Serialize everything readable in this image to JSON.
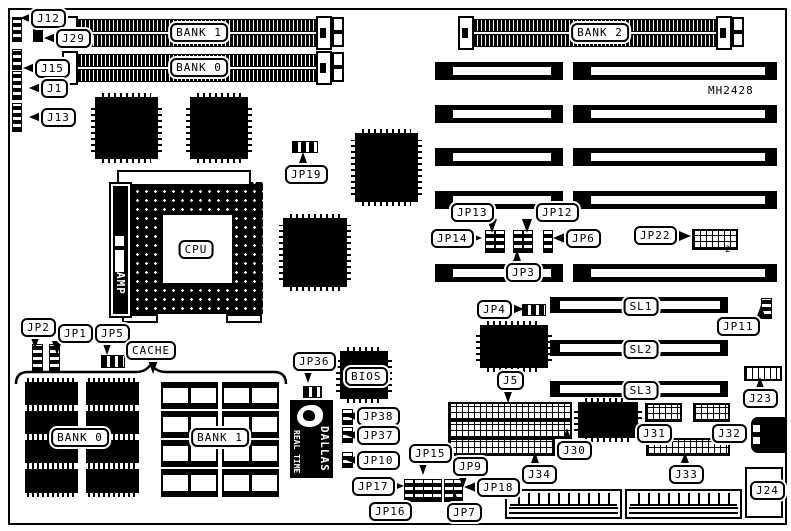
{
  "board": {
    "part_number": "MH2428"
  },
  "memory": {
    "simm_bank1": "BANK 1",
    "simm_bank0": "BANK 0",
    "simm_bank2": "BANK 2",
    "cache_bank0": "BANK 0",
    "cache_bank1": "BANK 1"
  },
  "slots": {
    "sl1": "SL1",
    "sl2": "SL2",
    "sl3": "SL3"
  },
  "chips": {
    "cpu": "CPU",
    "cpu_socket_brand": "AMP",
    "bios": "BIOS",
    "rtc_line1": "DALLAS",
    "rtc_line2": "REAL TIME"
  },
  "callouts": {
    "j12": "J12",
    "j29": "J29",
    "j15": "J15",
    "j1": "J1",
    "j13": "J13",
    "jp19": "JP19",
    "jp13": "JP13",
    "jp12": "JP12",
    "jp14": "JP14",
    "jp6": "JP6",
    "jp3": "JP3",
    "jp22": "JP22",
    "jp4": "JP4",
    "jp11": "JP11",
    "j5": "J5",
    "j23": "J23",
    "jp2": "JP2",
    "jp1": "JP1",
    "jp5": "JP5",
    "cache": "CACHE",
    "jp36": "JP36",
    "jp38": "JP38",
    "jp37": "JP37",
    "jp10": "JP10",
    "jp17": "JP17",
    "jp16": "JP16",
    "jp15": "JP15",
    "jp9": "JP9",
    "jp18": "JP18",
    "jp7": "JP7",
    "j34": "J34",
    "j30": "J30",
    "j31": "J31",
    "j32": "J32",
    "j33": "J33",
    "j24": "J24"
  },
  "annotations": {
    "jp22_pin2": "2"
  }
}
